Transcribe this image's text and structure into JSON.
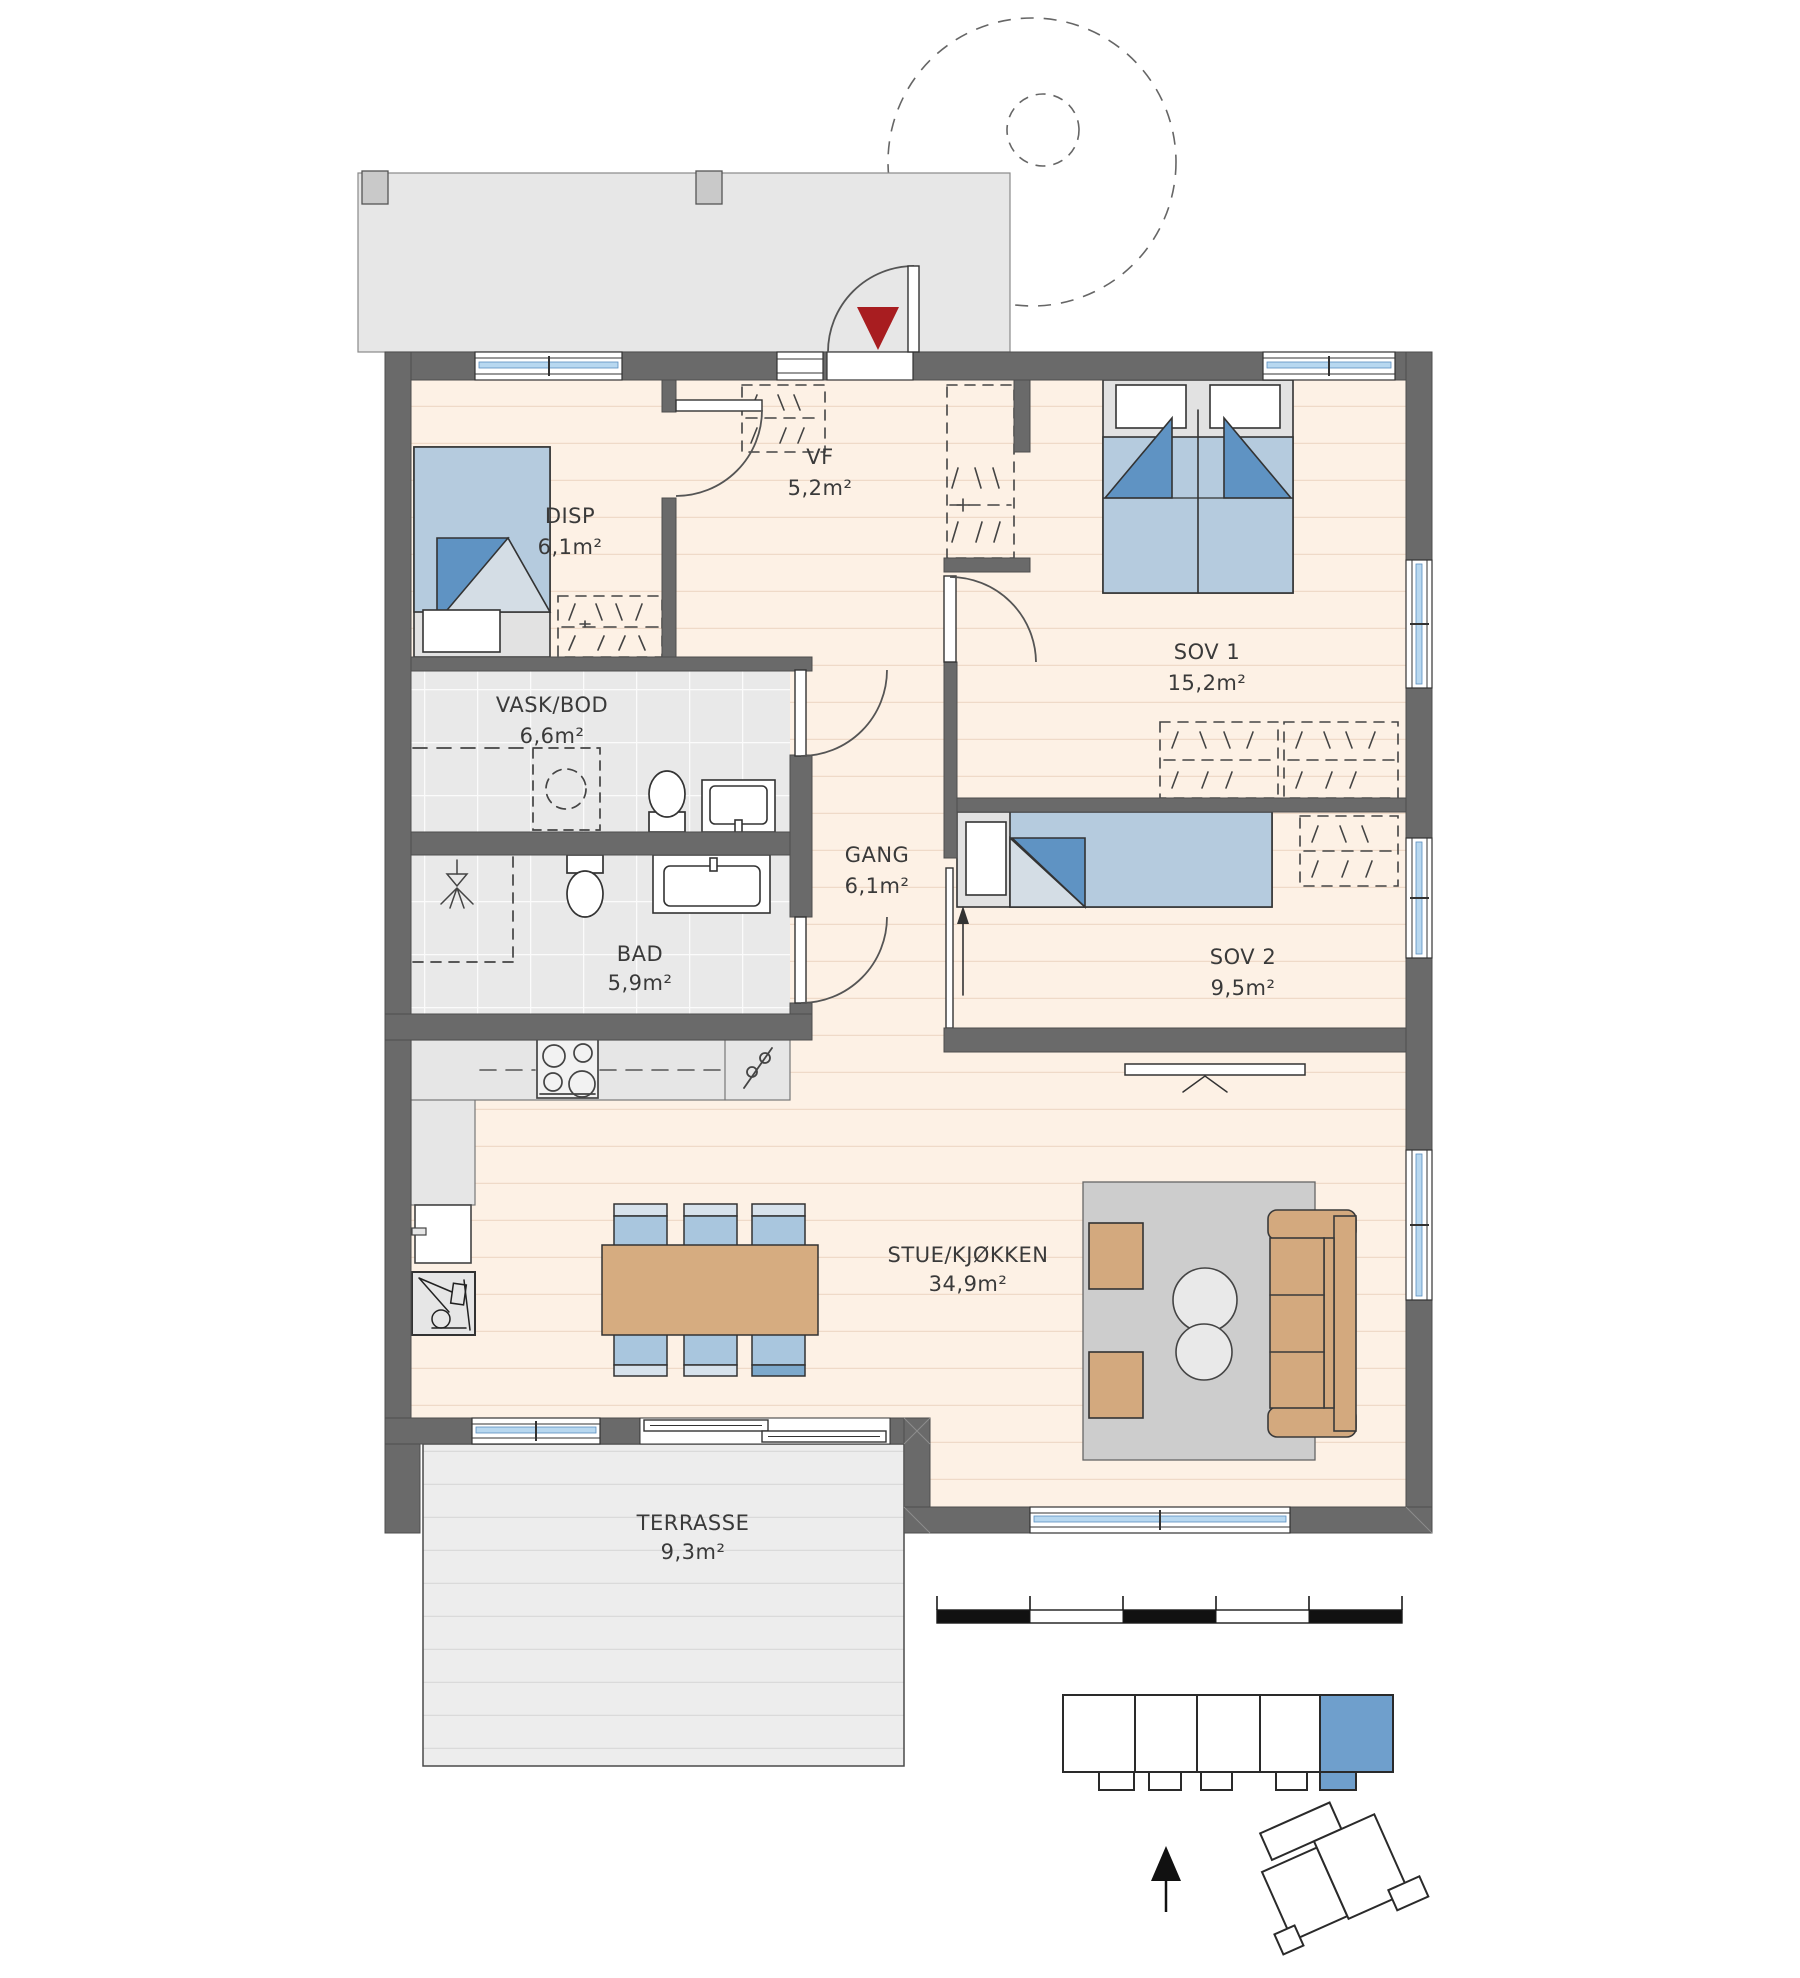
{
  "rooms": {
    "disp": {
      "name": "DISP",
      "area": "6,1m²"
    },
    "vf": {
      "name": "VF",
      "area": "5,2m²"
    },
    "sov1": {
      "name": "SOV 1",
      "area": "15,2m²"
    },
    "vaskbod": {
      "name": "VASK/BOD",
      "area": "6,6m²"
    },
    "gang": {
      "name": "GANG",
      "area": "6,1m²"
    },
    "sov2": {
      "name": "SOV 2",
      "area": "9,5m²"
    },
    "bad": {
      "name": "BAD",
      "area": "5,9m²"
    },
    "stue": {
      "name": "STUE/KJØKKEN",
      "area": "34,9m²"
    },
    "terrasse": {
      "name": "TERRASSE",
      "area": "9,3m²"
    }
  },
  "colors": {
    "entrance_marker": "#a81d20",
    "unit_highlight": "#6f9fcc",
    "wall": "#6a6a6a",
    "wood_floor": "#fdf1e5",
    "tile_floor": "#e9e9e9",
    "furniture_blue": "#b5cbde",
    "furniture_blue_dark": "#5f93c3",
    "furniture_tan": "#d3a97e",
    "glazing_blue": "#b8d8f0"
  },
  "icons": {
    "entrance_marker_icon": "▼",
    "north_arrow_icon": "▲"
  },
  "scale_bar": {
    "segments": 5
  },
  "site_plan": {
    "unit_count": 5,
    "highlighted_unit": "rightmost"
  }
}
